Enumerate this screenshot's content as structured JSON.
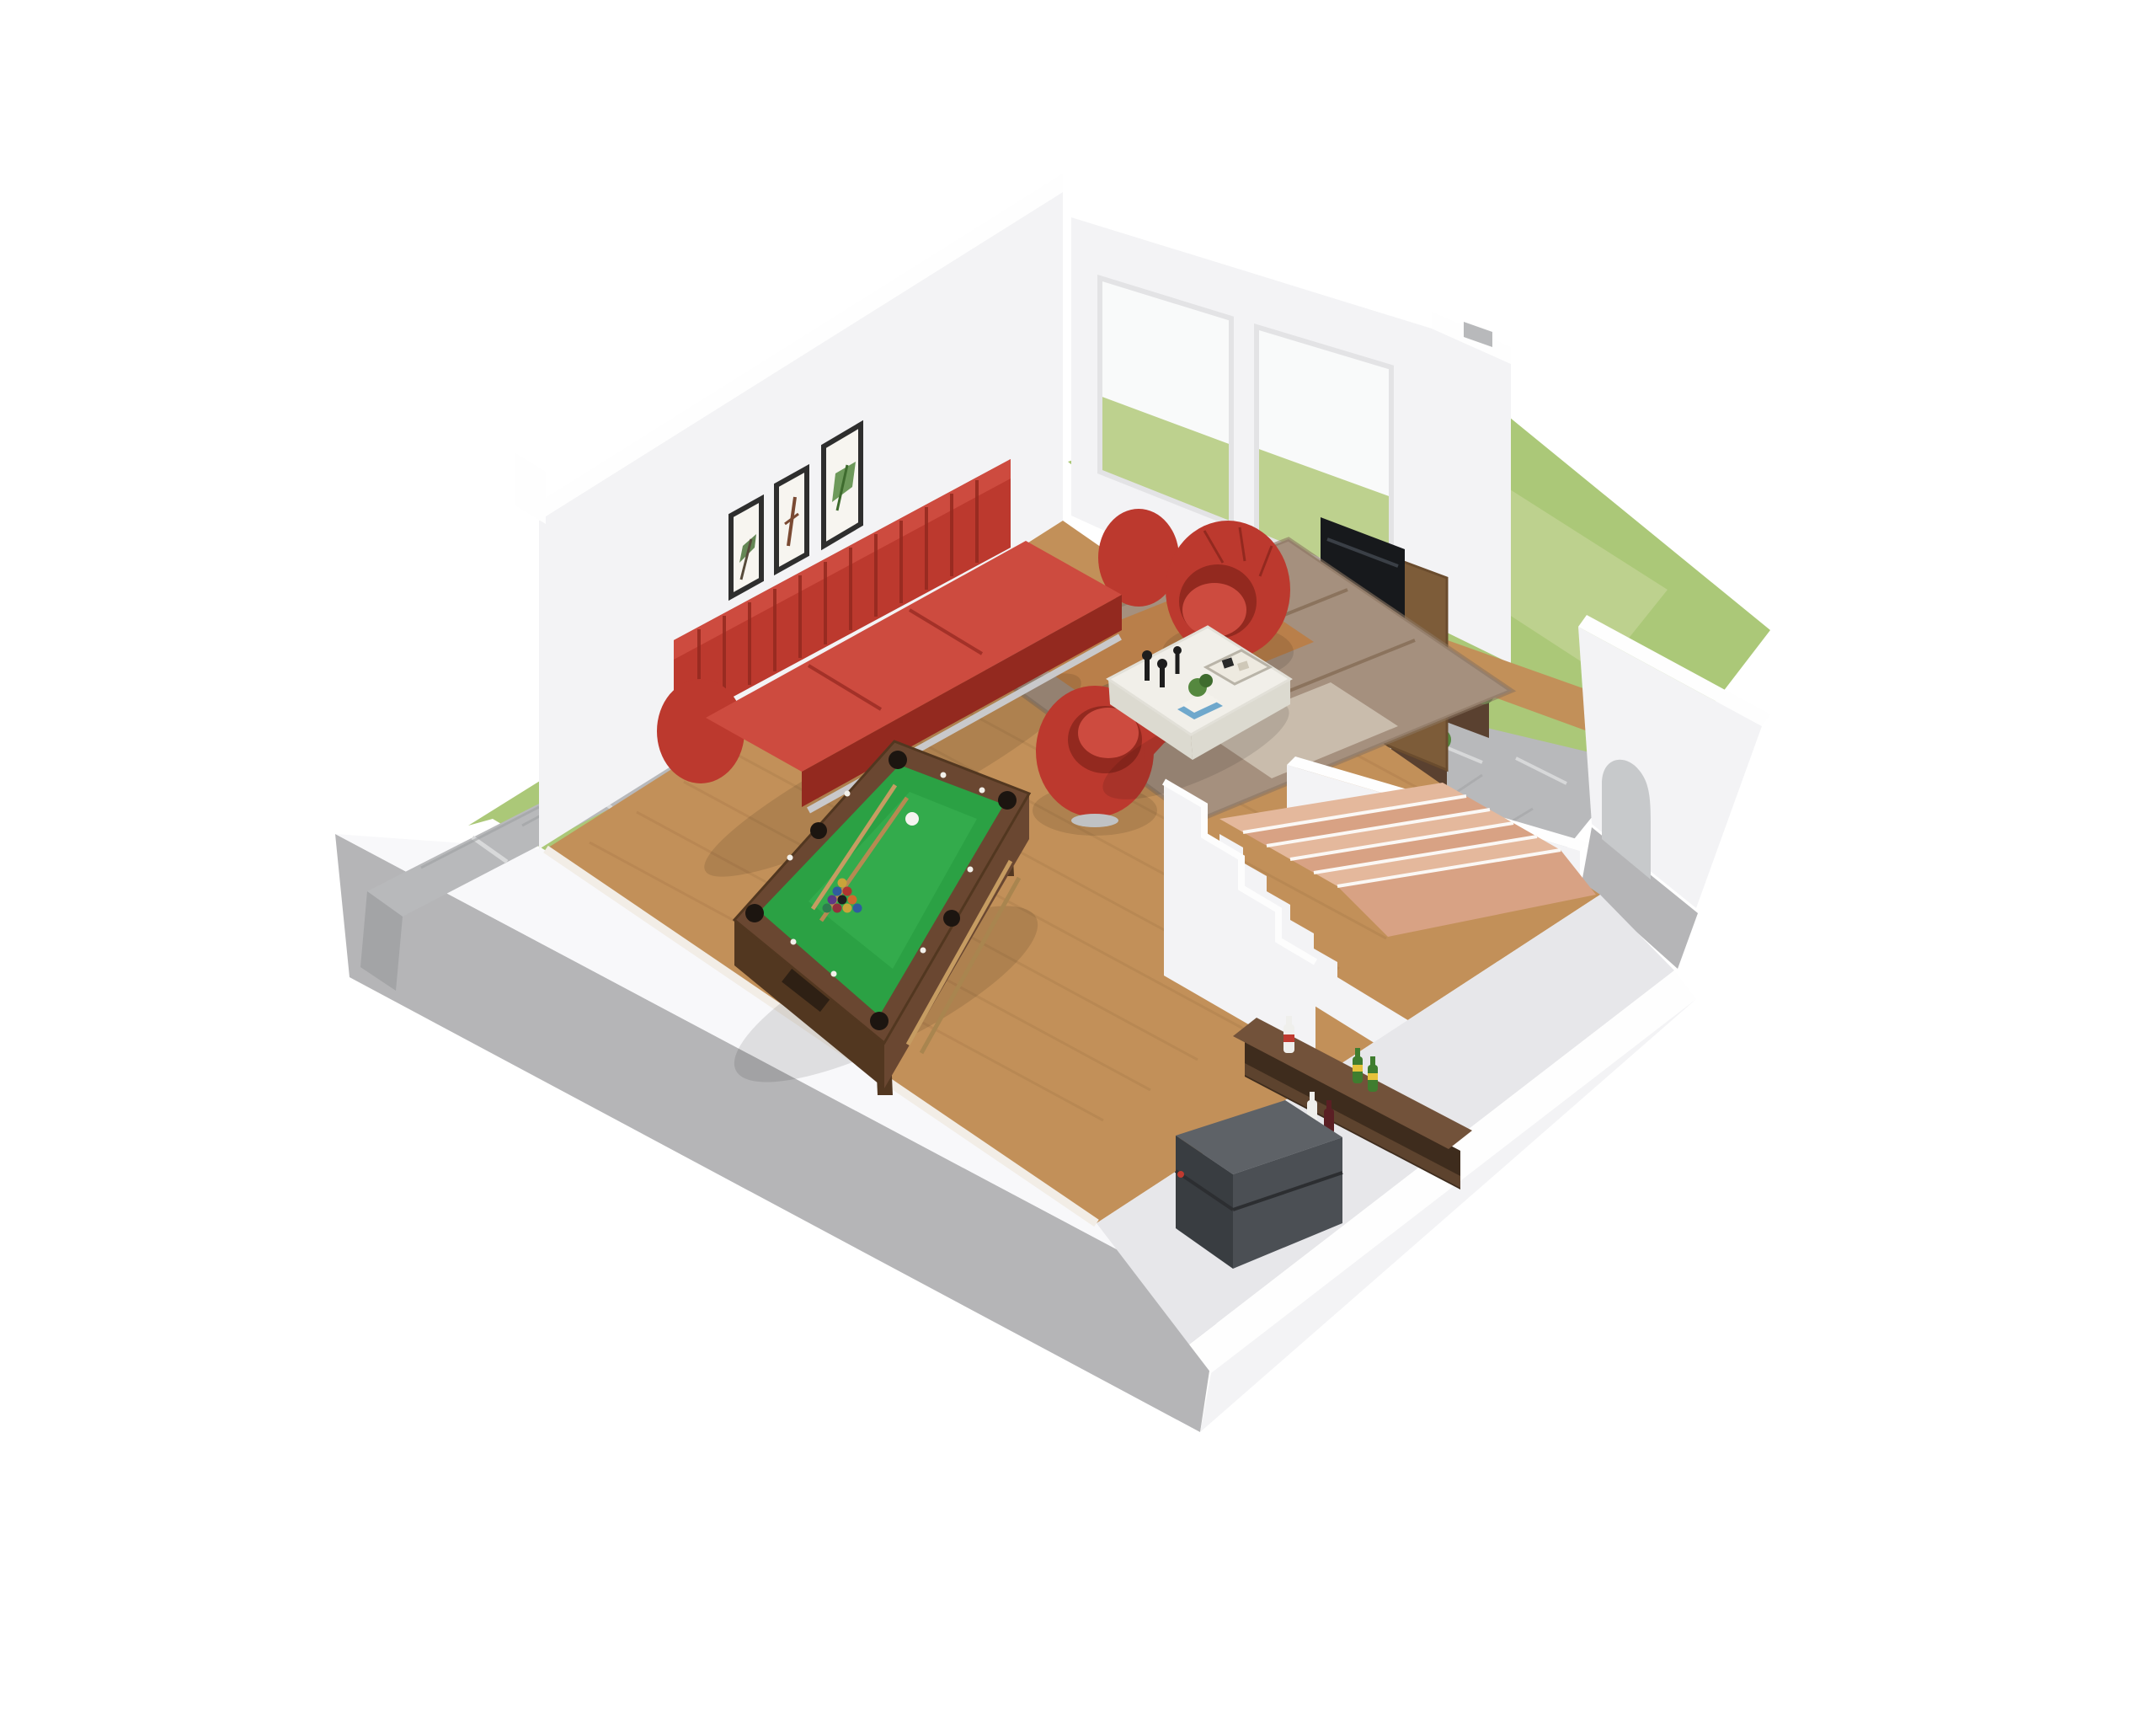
{
  "scene": {
    "view": "isometric-dollhouse-cutaway",
    "setting": "basement entertainment room 3D floor plan on white background",
    "objects": [
      "red channel-tufted sofa",
      "two red swivel tub chairs",
      "white organic-shaped coffee table with candlesticks, tray and potted plant",
      "taupe area rug",
      "billiard table with green felt, two cues, cue ball and racked balls",
      "three framed botanical wall prints",
      "sliding glass door with lawn visible",
      "flat-screen TV on walnut media panel",
      "sunken courtyard with stone paving, wood deck edge and planters",
      "staircase with wood treads and white stringer walls",
      "under-stair bar shelf with bottles",
      "dark grey mini fridge",
      "white garden wall with arched opening",
      "exterior flagstone steps",
      "lawn surrounding the walls",
      "grey concrete base plinth"
    ],
    "counts": {
      "wall_art_frames": 3,
      "billiard_cues": 2,
      "racked_balls": 10,
      "cue_balls": 1,
      "bar_bottles": 5,
      "planter_clusters": 3,
      "stair_treads": 6,
      "exterior_steps": 4,
      "sliding_door_panels": 2
    }
  },
  "colors": {
    "background": "#ffffff",
    "grass": "#abc878",
    "grass_light": "#bdd18e",
    "base_gray": "#b5b5b7",
    "base_gray_dark": "#a7a7a9",
    "curb_white": "#f8f8fa",
    "wall_white": "#f3f3f5",
    "wall_rim": "#fefefe",
    "wall_shade": "#e7e7ea",
    "glass_sky": "#f9fafa",
    "floor_wood": "#c29059",
    "plank_line": "#a87a48",
    "stone": "#b8b9bb",
    "stone_joint": "#d7d8d9",
    "stone_dark": "#a3a4a6",
    "rug_base": "#a5907e",
    "rug_rust": "#c07a3a",
    "rug_dark": "#7a6048",
    "rug_cream": "#d9cfc0",
    "sofa_red": "#bc392e",
    "sofa_red_dark": "#93291f",
    "sofa_red_light": "#cd4b3f",
    "table_white": "#f1efe9",
    "table_shade": "#dcdad0",
    "felt_green": "#2ba144",
    "felt_light": "#3bb553",
    "pool_frame": "#6a4731",
    "pool_frame_dark": "#523720",
    "cue_tan": "#c69c62",
    "stair_wood": "#d8a284",
    "stair_wood_light": "#e4b89c",
    "walnut": "#5d432e",
    "walnut_top": "#72523a",
    "walnut_dark": "#3e2c1d",
    "tv_black": "#17191c",
    "tv_panel": "#7d5c39",
    "fridge": "#4b4f54",
    "fridge_dark": "#393d41",
    "fridge_top": "#5e6267",
    "plant_green": "#55883f",
    "plant_dark": "#3e6b2e",
    "planter": "#5a4130",
    "frame_dark": "#2e2e2e",
    "mat_white": "#f7f5f0",
    "bottle_green": "#3f7d2f",
    "label_yellow": "#e5c23a",
    "label_red": "#c03a30",
    "bottle_white": "#efefec",
    "wine_dark": "#5a1f24",
    "shadow": "rgba(0,0,0,0.10)"
  }
}
